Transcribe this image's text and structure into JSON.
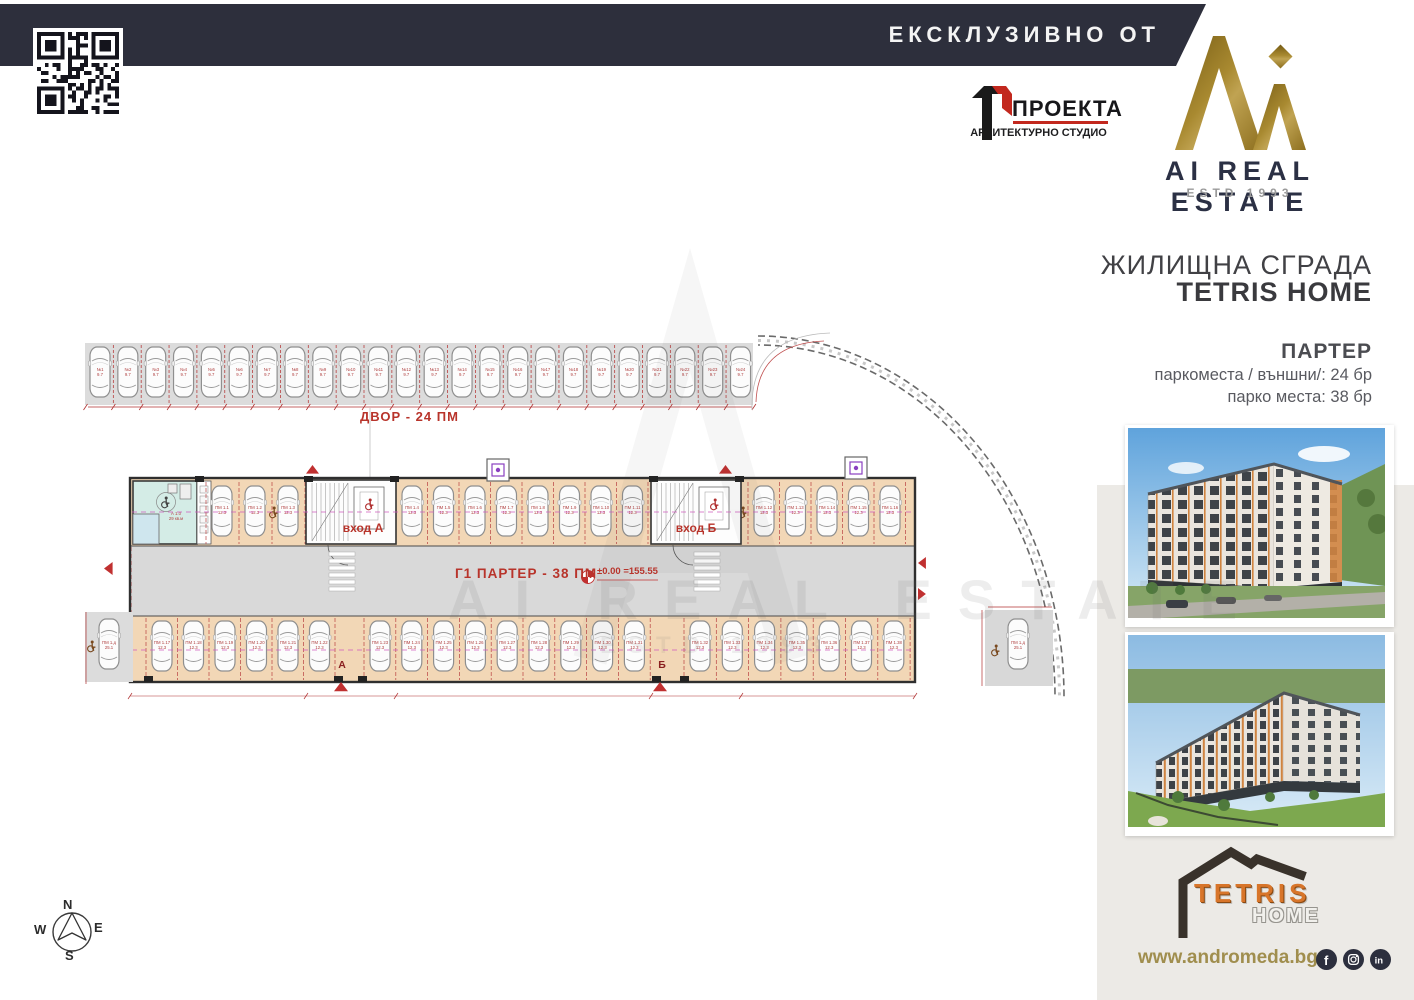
{
  "banner": {
    "label": "ЕКСКЛУЗИВНО ОТ"
  },
  "architect_logo": {
    "name": "ПРОЕКТА",
    "subtitle": "АРХИТЕКТУРНО СТУДИО"
  },
  "brand": {
    "name": "AI REAL ESTATE",
    "estd": "ESTD 1993"
  },
  "project": {
    "type": "ЖИЛИЩНА СГРАДА",
    "name": "TETRIS HOME"
  },
  "floor_info": {
    "title": "ПАРТЕР",
    "outdoor": "паркоместа / външни/: 24 бр",
    "indoor": "парко места: 38 бр"
  },
  "plan": {
    "yard_label": "ДВОР  - 24 ПМ",
    "garage_label": "Г1  ПАРТЕР - 38 ПМ",
    "level_mark": "±0.00 =155.55",
    "entrance_a": "вход А",
    "entrance_b": "вход Б",
    "door_a": "А",
    "door_b": "Б",
    "yard_count": 24,
    "garage_top_count": 16,
    "garage_bottom_count": 22,
    "yard_space_prefix": "№",
    "yard_space_area": "9.7",
    "garage_space_prefix": "ПМ 1.",
    "garage_space_area": "12.3",
    "accessible_space_area": "25.1",
    "room_label_1": "А 1.0",
    "room_label_2": "29 кв.м",
    "watermark": "AI REAL ESTATE",
    "watermark2": "ESTD 1993",
    "compass": {
      "n": "N",
      "e": "E",
      "s": "S",
      "w": "W"
    }
  },
  "footer": {
    "website": "www.andromeda.bg",
    "logo_top": "TETRIS",
    "logo_bottom": "HOME",
    "social": [
      "facebook",
      "instagram",
      "linkedin"
    ]
  },
  "colors": {
    "banner": "#2d2f3c",
    "gold": "#9c7f24",
    "navy": "#2b3044",
    "red": "#b8342b",
    "peach": "#f2d7b6",
    "teal": "#d4ece6",
    "panel": "#eceae6",
    "plan_gray": "#dcdcdc",
    "orange": "#d8752a"
  }
}
